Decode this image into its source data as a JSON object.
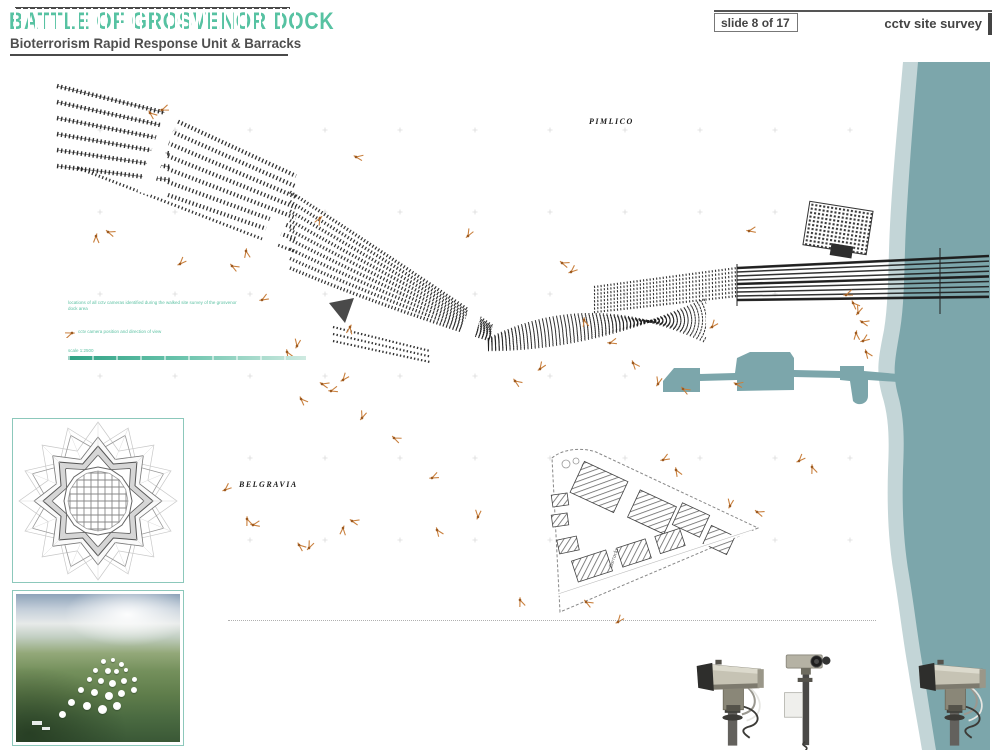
{
  "header": {
    "title": "BATTLE OF GROSVENOR DOCK",
    "subtitle": "Bioterrorism Rapid Response Unit & Barracks",
    "slide_indicator": "slide 8 of 17",
    "survey_label": "cctv site survey"
  },
  "colors": {
    "accent_teal": "#57c2a2",
    "river": "#7ca6ab",
    "foreshore": "#c3d5d7",
    "marker_orange": "#c9803e",
    "marker_dot": "#9d5a20",
    "inset_border": "#8cc8bb",
    "ink": "#1c1c1c"
  },
  "map": {
    "district_labels": [
      {
        "text": "PIMLICO",
        "x": 589,
        "y": 117
      },
      {
        "text": "BELGRAVIA",
        "x": 239,
        "y": 480
      }
    ],
    "street_label": "Barracks",
    "legend": {
      "line1": "locations of all cctv cameras identified during the walked site survey of the grosvenor dock area",
      "line2": "cctv camera position and direction of view",
      "line3": "scale 1:2500"
    },
    "markers": [
      [
        150,
        113,
        40
      ],
      [
        162,
        110,
        -20
      ],
      [
        356,
        157,
        10
      ],
      [
        320,
        218,
        120
      ],
      [
        468,
        236,
        -60
      ],
      [
        96,
        236,
        90
      ],
      [
        108,
        232,
        20
      ],
      [
        180,
        264,
        -45
      ],
      [
        232,
        266,
        30
      ],
      [
        246,
        251,
        80
      ],
      [
        262,
        300,
        -30
      ],
      [
        287,
        352,
        60
      ],
      [
        297,
        346,
        -80
      ],
      [
        322,
        384,
        15
      ],
      [
        343,
        380,
        -50
      ],
      [
        350,
        327,
        100
      ],
      [
        331,
        391,
        -15
      ],
      [
        301,
        399,
        45
      ],
      [
        362,
        418,
        -70
      ],
      [
        394,
        438,
        25
      ],
      [
        225,
        490,
        -40
      ],
      [
        247,
        519,
        70
      ],
      [
        253,
        525,
        -10
      ],
      [
        299,
        545,
        40
      ],
      [
        309,
        548,
        -65
      ],
      [
        352,
        521,
        15
      ],
      [
        343,
        528,
        95
      ],
      [
        432,
        478,
        -25
      ],
      [
        437,
        530,
        55
      ],
      [
        478,
        517,
        -85
      ],
      [
        515,
        381,
        35
      ],
      [
        540,
        369,
        -55
      ],
      [
        562,
        263,
        20
      ],
      [
        571,
        272,
        -40
      ],
      [
        584,
        320,
        75
      ],
      [
        610,
        343,
        -15
      ],
      [
        633,
        363,
        50
      ],
      [
        658,
        384,
        -75
      ],
      [
        683,
        389,
        30
      ],
      [
        712,
        327,
        -50
      ],
      [
        736,
        384,
        10
      ],
      [
        663,
        460,
        -30
      ],
      [
        676,
        470,
        60
      ],
      [
        730,
        506,
        -80
      ],
      [
        757,
        512,
        20
      ],
      [
        799,
        461,
        -45
      ],
      [
        812,
        467,
        70
      ],
      [
        846,
        295,
        -20
      ],
      [
        853,
        303,
        45
      ],
      [
        858,
        313,
        -70
      ],
      [
        862,
        322,
        15
      ],
      [
        856,
        333,
        85
      ],
      [
        863,
        341,
        -35
      ],
      [
        866,
        352,
        55
      ],
      [
        749,
        231,
        -10
      ],
      [
        586,
        602,
        30
      ],
      [
        618,
        622,
        -50
      ],
      [
        520,
        600,
        70
      ]
    ]
  }
}
